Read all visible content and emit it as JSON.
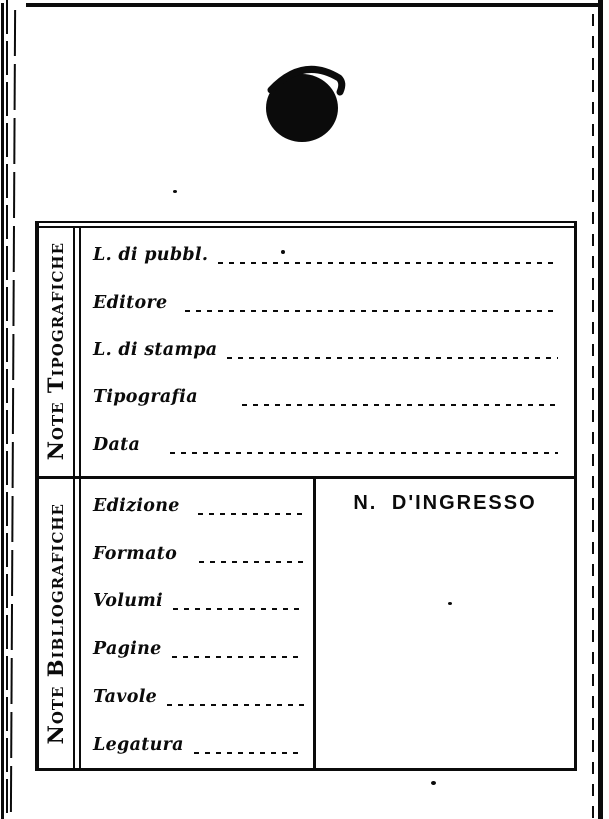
{
  "card": {
    "sections": [
      {
        "side_label": "Note Tipografiche",
        "fields": [
          {
            "label": "L. di pubbl."
          },
          {
            "label": "Editore"
          },
          {
            "label": "L. di stampa"
          },
          {
            "label": "Tipografia"
          },
          {
            "label": "Data"
          }
        ]
      },
      {
        "side_label": "Note Bibliografiche",
        "fields": [
          {
            "label": "Edizione"
          },
          {
            "label": "Formato"
          },
          {
            "label": "Volumi"
          },
          {
            "label": "Pagine"
          },
          {
            "label": "Tavole"
          },
          {
            "label": "Legatura"
          }
        ],
        "entry_number_heading": "N. D'INGRESSO"
      }
    ]
  },
  "decorations": {
    "ink_blot_icon": "ink-blot",
    "ink_color": "#0b0b0b",
    "paper_color": "#ffffff"
  }
}
